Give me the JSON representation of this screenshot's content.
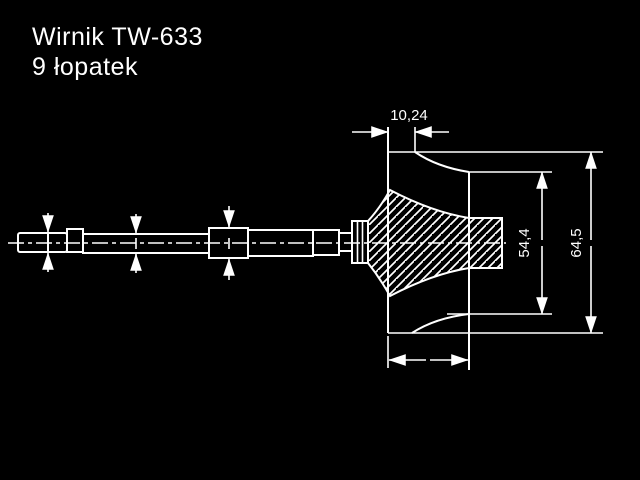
{
  "title": {
    "line1": "Wirnik TW-633",
    "line2": "9 łopatek"
  },
  "dimensions": {
    "inducer_width": "10,24",
    "exducer_diameter": "54,4",
    "wheel_diameter": "64,5"
  },
  "colors": {
    "background": "#000000",
    "line": "#ffffff"
  }
}
